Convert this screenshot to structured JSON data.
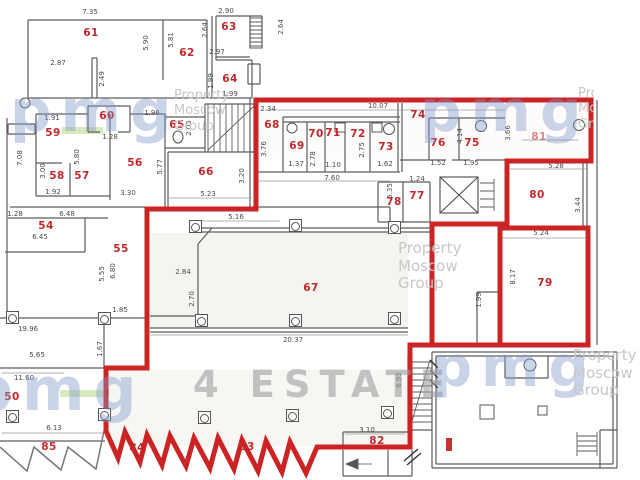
{
  "colors": {
    "boundary_red": "#cc2424",
    "label_red": "#c3282b",
    "wall_gray": "#5c5c5c",
    "highlight_green": "#cfe6b2",
    "watermark_blue": "rgba(128,152,202,0.42)",
    "watermark_gray": "#c7c7c7"
  },
  "watermarks": {
    "logo_text": "pmg",
    "brand_lines": [
      "Property",
      "Moscow",
      "Group"
    ],
    "estate_text": "4 ESTATE",
    "logo_positions": [
      {
        "x": 10,
        "y": 82,
        "size": 58
      },
      {
        "x": 420,
        "y": 82,
        "size": 58
      },
      {
        "x": -30,
        "y": 360,
        "size": 60
      },
      {
        "x": 432,
        "y": 340,
        "size": 56
      }
    ],
    "brand_positions": [
      {
        "x": 174,
        "y": 88,
        "small": true
      },
      {
        "x": 398,
        "y": 240
      },
      {
        "x": 573,
        "y": 347
      },
      {
        "x": 578,
        "y": 86,
        "clip": 16,
        "small": true
      }
    ]
  },
  "rooms": [
    {
      "n": "50",
      "x": 12,
      "y": 397
    },
    {
      "n": "54",
      "x": 46,
      "y": 226
    },
    {
      "n": "55",
      "x": 121,
      "y": 249
    },
    {
      "n": "56",
      "x": 135,
      "y": 163
    },
    {
      "n": "57",
      "x": 82,
      "y": 176
    },
    {
      "n": "58",
      "x": 57,
      "y": 176
    },
    {
      "n": "59",
      "x": 53,
      "y": 133
    },
    {
      "n": "60",
      "x": 107,
      "y": 116
    },
    {
      "n": "61",
      "x": 91,
      "y": 33
    },
    {
      "n": "62",
      "x": 187,
      "y": 53
    },
    {
      "n": "63",
      "x": 229,
      "y": 27
    },
    {
      "n": "64",
      "x": 230,
      "y": 79
    },
    {
      "n": "65",
      "x": 177,
      "y": 125
    },
    {
      "n": "66",
      "x": 206,
      "y": 172
    },
    {
      "n": "67",
      "x": 311,
      "y": 288
    },
    {
      "n": "68",
      "x": 272,
      "y": 125
    },
    {
      "n": "69",
      "x": 297,
      "y": 146
    },
    {
      "n": "70",
      "x": 316,
      "y": 134
    },
    {
      "n": "71",
      "x": 333,
      "y": 133
    },
    {
      "n": "72",
      "x": 358,
      "y": 134
    },
    {
      "n": "73",
      "x": 386,
      "y": 147
    },
    {
      "n": "74",
      "x": 418,
      "y": 115
    },
    {
      "n": "75",
      "x": 472,
      "y": 143
    },
    {
      "n": "76",
      "x": 438,
      "y": 143
    },
    {
      "n": "77",
      "x": 417,
      "y": 196
    },
    {
      "n": "78",
      "x": 394,
      "y": 202
    },
    {
      "n": "79",
      "x": 545,
      "y": 283
    },
    {
      "n": "80",
      "x": 537,
      "y": 195
    },
    {
      "n": "81",
      "x": 539,
      "y": 137,
      "o": 0.55
    },
    {
      "n": "82",
      "x": 377,
      "y": 441
    },
    {
      "n": "83",
      "x": 247,
      "y": 447
    },
    {
      "n": "84",
      "x": 137,
      "y": 448
    },
    {
      "n": "85",
      "x": 49,
      "y": 447
    }
  ],
  "dimensions": [
    {
      "t": "7.35",
      "x": 90,
      "y": 12
    },
    {
      "t": "2.87",
      "x": 58,
      "y": 63
    },
    {
      "t": "5.90",
      "x": 146,
      "y": 43,
      "v": 1
    },
    {
      "t": "5.81",
      "x": 171,
      "y": 40,
      "v": 1
    },
    {
      "t": "2.49",
      "x": 102,
      "y": 79,
      "v": 1
    },
    {
      "t": "2.64",
      "x": 205,
      "y": 30,
      "v": 1
    },
    {
      "t": "2.90",
      "x": 226,
      "y": 11
    },
    {
      "t": "2.97",
      "x": 217,
      "y": 52
    },
    {
      "t": "2.64",
      "x": 281,
      "y": 27,
      "v": 1
    },
    {
      "t": "1.99",
      "x": 211,
      "y": 81,
      "v": 1
    },
    {
      "t": "1.99",
      "x": 230,
      "y": 94
    },
    {
      "t": "1.96",
      "x": 152,
      "y": 113
    },
    {
      "t": "2.05",
      "x": 189,
      "y": 128,
      "v": 1
    },
    {
      "t": "5.77",
      "x": 160,
      "y": 167,
      "v": 1
    },
    {
      "t": "5.23",
      "x": 208,
      "y": 194
    },
    {
      "t": "3.20",
      "x": 242,
      "y": 176,
      "v": 1
    },
    {
      "t": "3.30",
      "x": 128,
      "y": 193
    },
    {
      "t": "5.16",
      "x": 236,
      "y": 217
    },
    {
      "t": "7.08",
      "x": 20,
      "y": 158,
      "v": 1
    },
    {
      "t": "1.91",
      "x": 52,
      "y": 118
    },
    {
      "t": "1.28",
      "x": 110,
      "y": 137
    },
    {
      "t": "5.80",
      "x": 77,
      "y": 157,
      "v": 1
    },
    {
      "t": "3.00",
      "x": 43,
      "y": 171,
      "v": 1
    },
    {
      "t": "1.92",
      "x": 53,
      "y": 192
    },
    {
      "t": "1.28",
      "x": 15,
      "y": 214
    },
    {
      "t": "6.48",
      "x": 67,
      "y": 214
    },
    {
      "t": "6.45",
      "x": 40,
      "y": 237
    },
    {
      "t": "5.55",
      "x": 102,
      "y": 274,
      "v": 1
    },
    {
      "t": "6.80",
      "x": 113,
      "y": 271,
      "v": 1
    },
    {
      "t": "1.85",
      "x": 120,
      "y": 310
    },
    {
      "t": "19.96",
      "x": 28,
      "y": 329
    },
    {
      "t": "11.60",
      "x": 24,
      "y": 378
    },
    {
      "t": "1.67",
      "x": 100,
      "y": 349,
      "v": 1
    },
    {
      "t": "6.13",
      "x": 54,
      "y": 428
    },
    {
      "t": "5.65",
      "x": 37,
      "y": 355
    },
    {
      "t": "2.84",
      "x": 183,
      "y": 272
    },
    {
      "t": "2.70",
      "x": 192,
      "y": 299,
      "v": 1
    },
    {
      "t": "20.37",
      "x": 293,
      "y": 340
    },
    {
      "t": "7.60",
      "x": 332,
      "y": 178
    },
    {
      "t": "1.24",
      "x": 417,
      "y": 179
    },
    {
      "t": "5.35",
      "x": 390,
      "y": 191,
      "v": 1
    },
    {
      "t": "2.34",
      "x": 268,
      "y": 109
    },
    {
      "t": "10.07",
      "x": 378,
      "y": 106
    },
    {
      "t": "3.76",
      "x": 264,
      "y": 149,
      "v": 1
    },
    {
      "t": "1.37",
      "x": 296,
      "y": 164
    },
    {
      "t": "2.78",
      "x": 313,
      "y": 159,
      "v": 1
    },
    {
      "t": "1.10",
      "x": 333,
      "y": 165
    },
    {
      "t": "2.75",
      "x": 362,
      "y": 150,
      "v": 1
    },
    {
      "t": "1.62",
      "x": 385,
      "y": 164
    },
    {
      "t": "1.52",
      "x": 438,
      "y": 163
    },
    {
      "t": "1.95",
      "x": 471,
      "y": 163
    },
    {
      "t": "4.14",
      "x": 460,
      "y": 136,
      "v": 1
    },
    {
      "t": "3.66",
      "x": 508,
      "y": 133,
      "v": 1
    },
    {
      "t": "5.28",
      "x": 556,
      "y": 166
    },
    {
      "t": "5.24",
      "x": 541,
      "y": 233
    },
    {
      "t": "8.17",
      "x": 513,
      "y": 277,
      "v": 1
    },
    {
      "t": "1.99",
      "x": 479,
      "y": 300,
      "v": 1
    },
    {
      "t": "3.44",
      "x": 578,
      "y": 205,
      "v": 1
    },
    {
      "t": "3.10",
      "x": 367,
      "y": 430
    },
    {
      "t": "6.93",
      "x": 399,
      "y": 380,
      "v": 1
    }
  ],
  "columns": [
    [
      195,
      226
    ],
    [
      295,
      225
    ],
    [
      394,
      227
    ],
    [
      201,
      320
    ],
    [
      295,
      320
    ],
    [
      394,
      318
    ],
    [
      12,
      317
    ],
    [
      104,
      318
    ],
    [
      12,
      416
    ],
    [
      104,
      414
    ],
    [
      204,
      417
    ],
    [
      292,
      415
    ],
    [
      387,
      412
    ]
  ],
  "green_highlights": [
    [
      62,
      127,
      41,
      7
    ],
    [
      468,
      128,
      38,
      7
    ],
    [
      286,
      280,
      36,
      7
    ],
    [
      60,
      390,
      50,
      7
    ]
  ]
}
